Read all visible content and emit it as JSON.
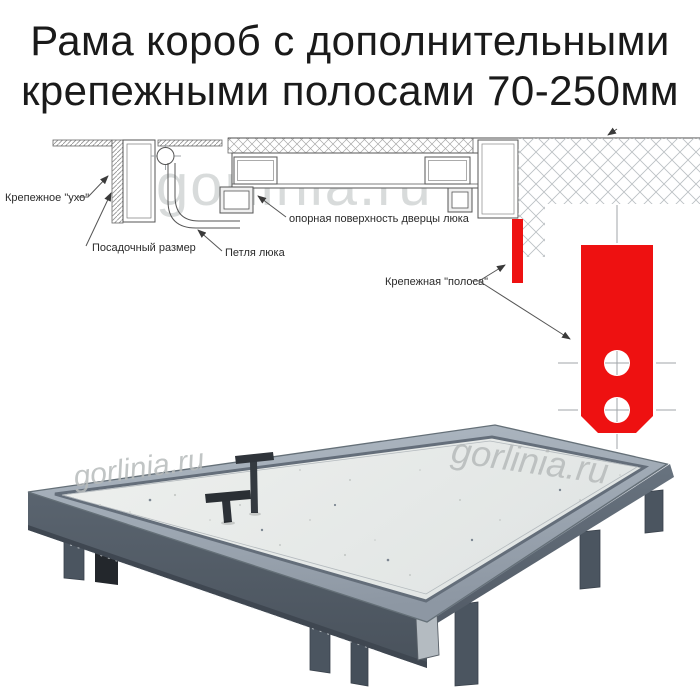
{
  "title": {
    "line1": "Рама короб с дополнительными",
    "line2": "крепежными полосами 70-250мм"
  },
  "watermark": {
    "text": "gorlinia.ru"
  },
  "diagram": {
    "labels": {
      "ear": "Крепежное \"ухо\"",
      "seat": "Посадочный размер",
      "hinge": "Петля люка",
      "support": "опорная поверхность дверцы люка",
      "strip": "Крепежная \"полоса\""
    },
    "colors": {
      "red": "#ee1111",
      "line": "#4d4d4d",
      "hatch": "#9a9a9a",
      "wall_hatch": "#bcc1c4"
    }
  },
  "photo": {
    "colors": {
      "frame_left_face": "#57616d",
      "frame_right_face": "#626d7a",
      "rim": "#9aa4af",
      "panel": "#e9ebe9",
      "legs": "#4b5560",
      "handles": "#2f343a"
    }
  }
}
